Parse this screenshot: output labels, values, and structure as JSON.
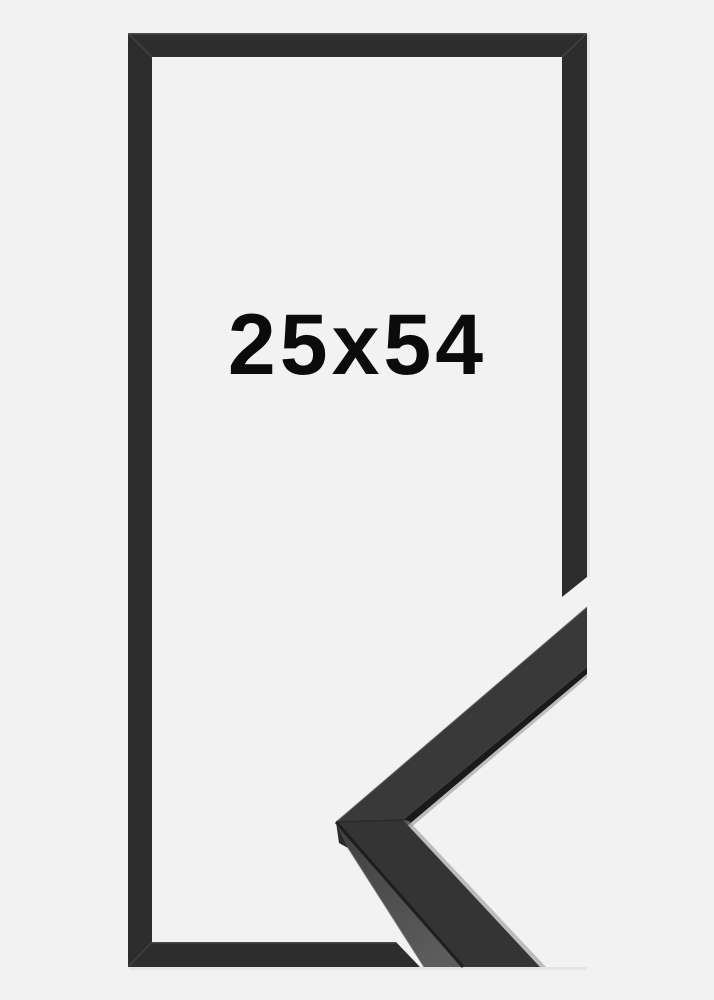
{
  "product": {
    "size_label": "25x54"
  },
  "theme": {
    "bg": "#f2f2f2",
    "frame": "#2d2d2d",
    "frame-highlight": "#6a6a6a",
    "moulding-top": "#39393a",
    "moulding-top-2": "#343435",
    "moulding-side-1": "#3f3f3f",
    "moulding-side-2": "#5c5c5c",
    "edge-dark": "#1a1a1a",
    "lip": "#8f8f8f",
    "seam": "#232323",
    "text": "#0b0b0b"
  }
}
